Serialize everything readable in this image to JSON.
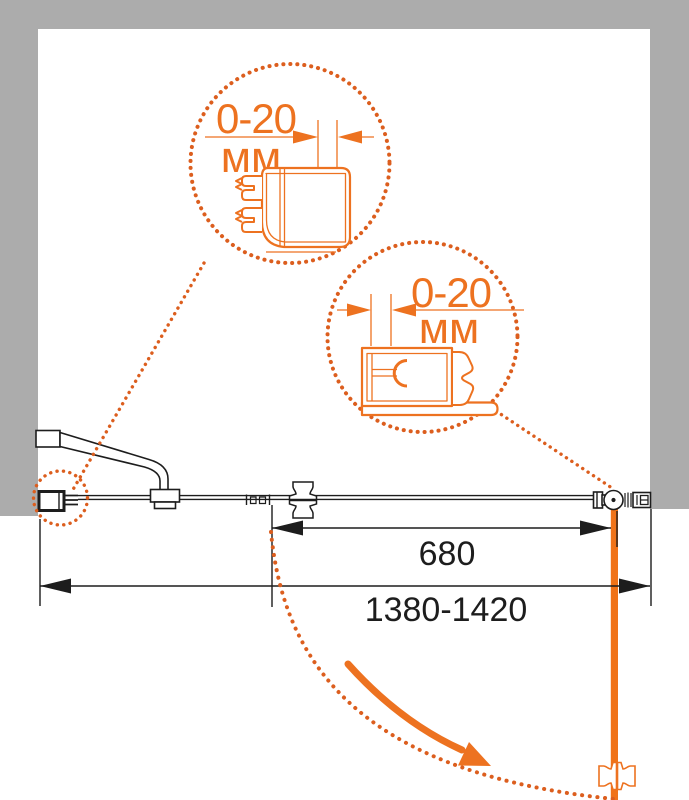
{
  "colors": {
    "accent": "#ED7220",
    "dots": "#DC5E1E",
    "door": "#F07318",
    "wall": "#ACACAC",
    "line": "#1D1D1D",
    "bg": "#FFFFFF"
  },
  "detail_circle_1": {
    "value": "0-20",
    "unit": "мм"
  },
  "detail_circle_2": {
    "value": "0-20",
    "unit": "мм"
  },
  "dimensions": {
    "door_width": "680",
    "overall_width": "1380-1420"
  }
}
